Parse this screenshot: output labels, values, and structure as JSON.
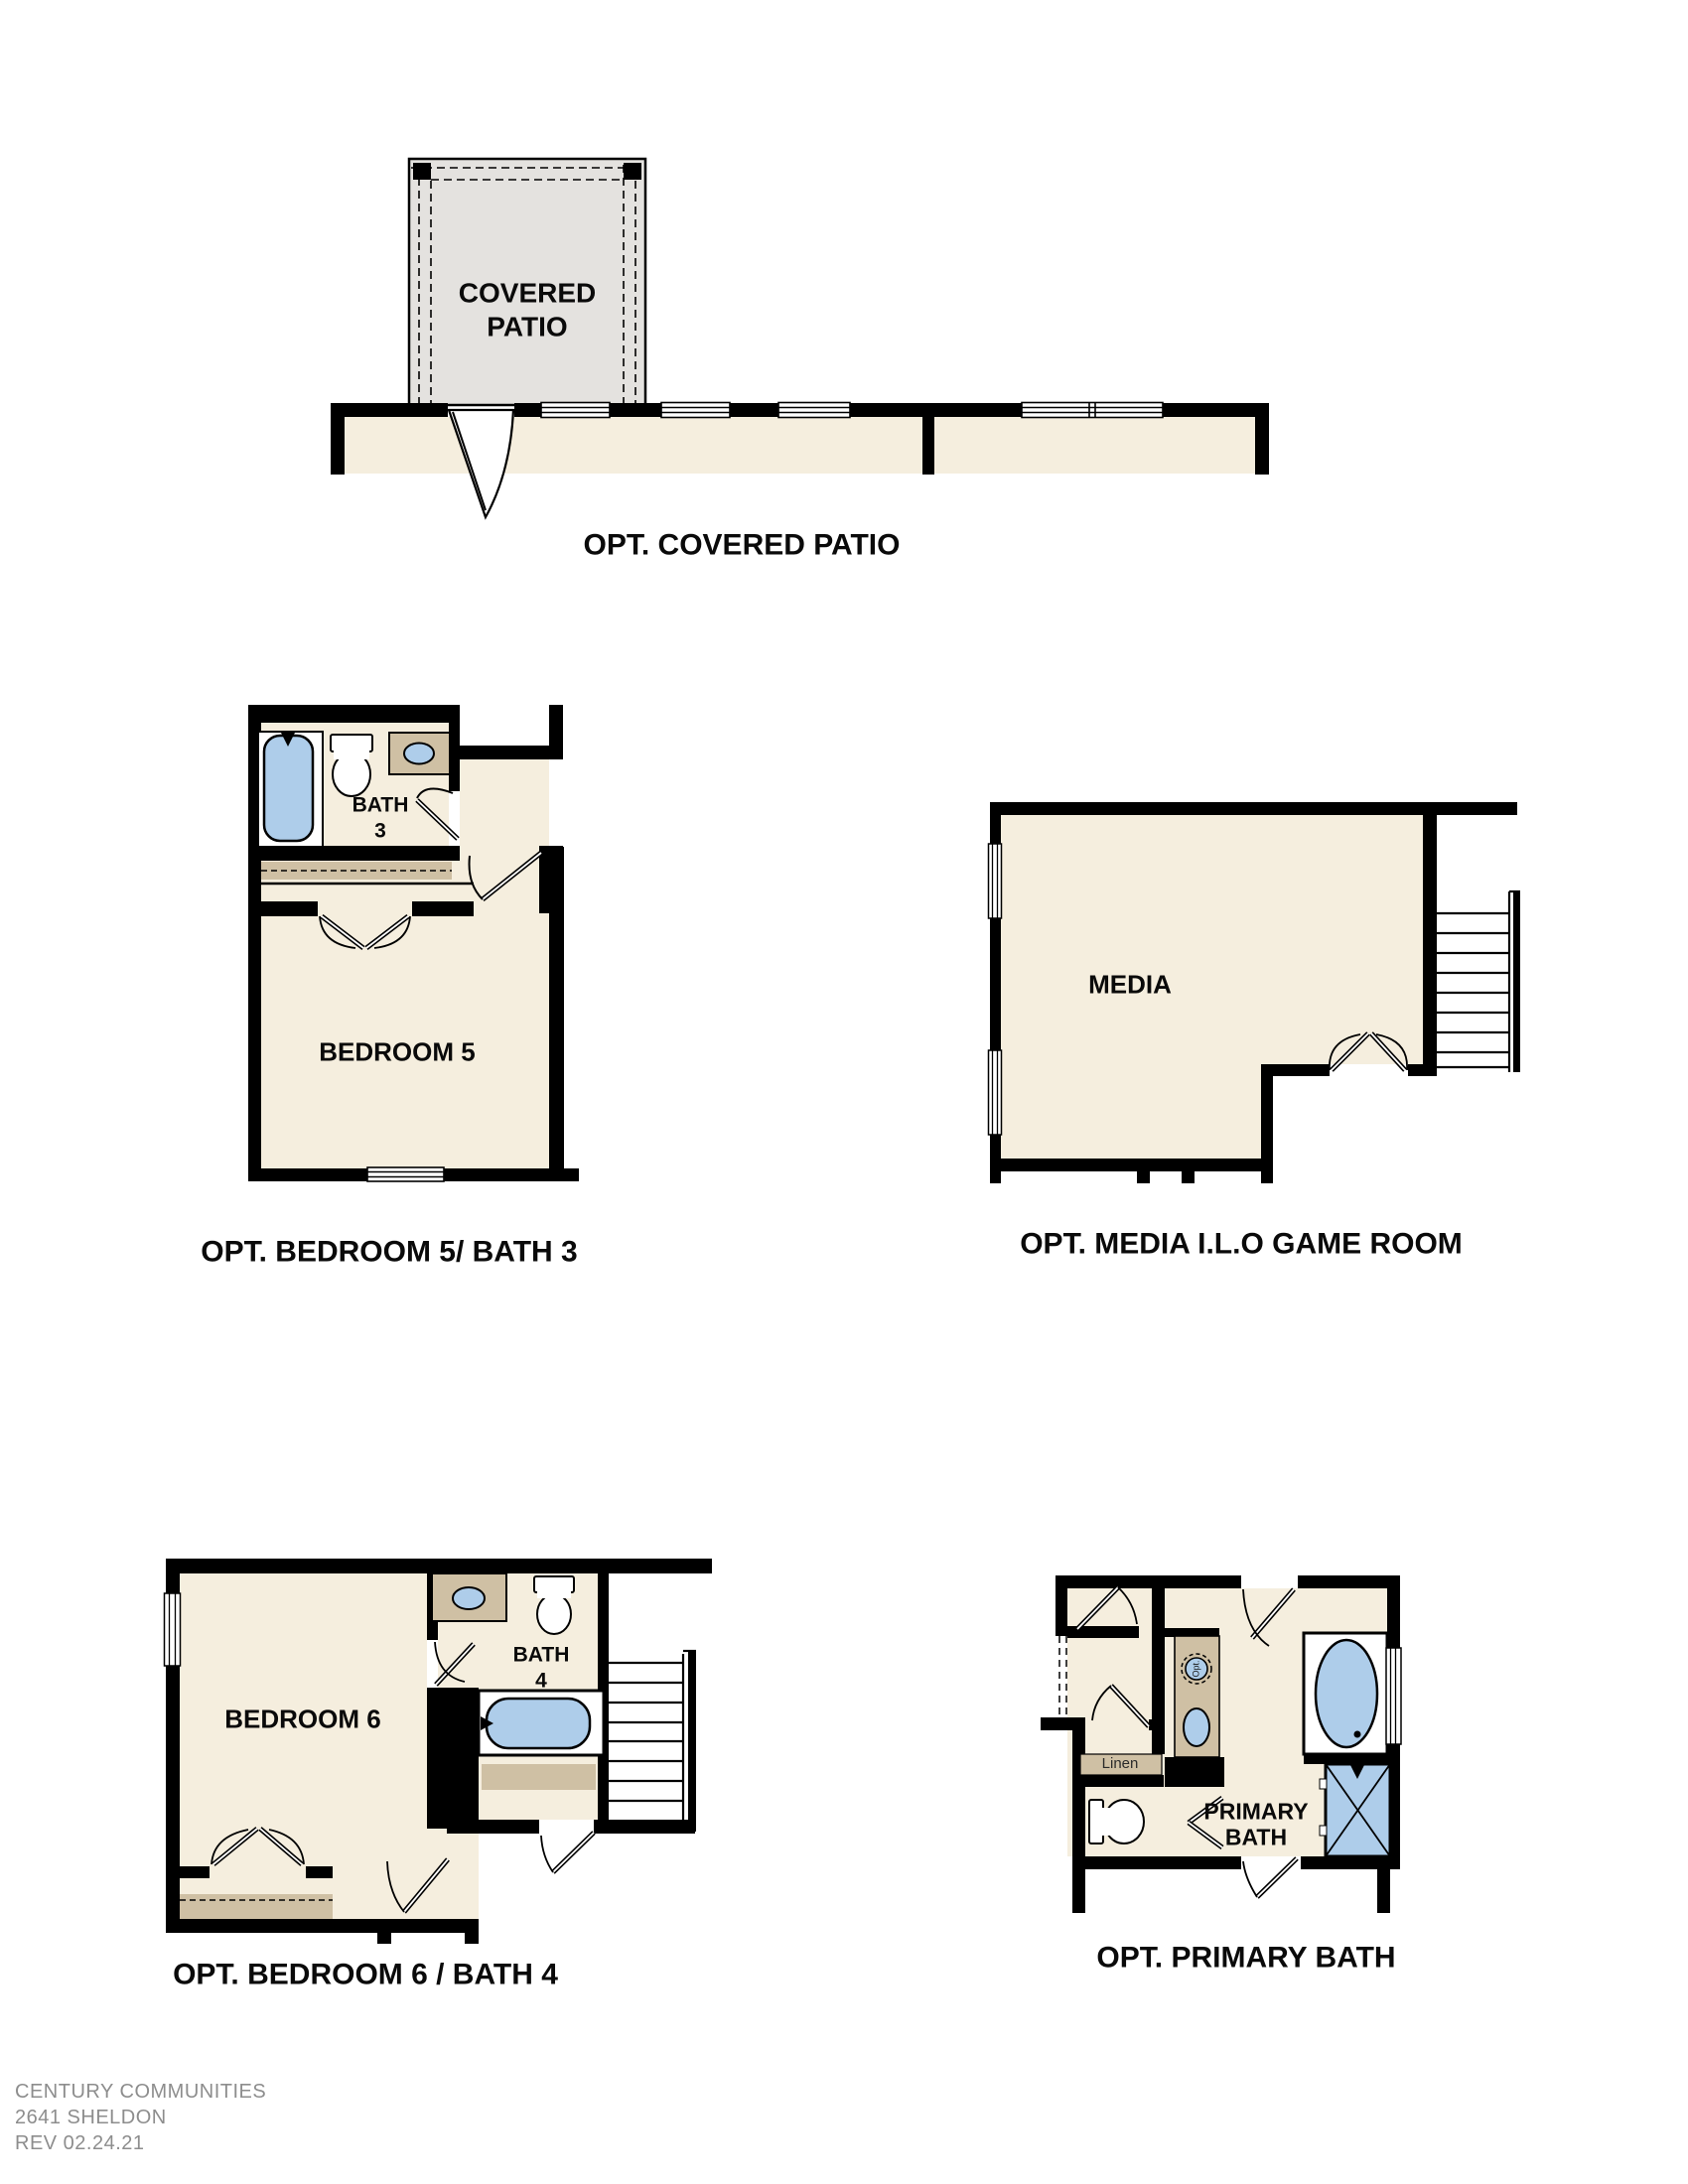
{
  "document": {
    "type": "floor-plan-options-sheet",
    "builder": "CENTURY COMMUNITIES",
    "plan_number": "2641 SHELDON",
    "revision": "REV 02.24.21"
  },
  "plans": {
    "covered_patio": {
      "caption": "OPT. COVERED PATIO",
      "room_label": "COVERED\nPATIO"
    },
    "bedroom5_bath3": {
      "caption": "OPT. BEDROOM 5/ BATH 3",
      "bath_label": "BATH\n3",
      "bedroom_label": "BEDROOM 5"
    },
    "media": {
      "caption": "OPT. MEDIA I.L.O GAME ROOM",
      "room_label": "MEDIA"
    },
    "bedroom6_bath4": {
      "caption": "OPT. BEDROOM 6 / BATH 4",
      "bedroom_label": "BEDROOM 6",
      "bath_label": "BATH\n4"
    },
    "primary_bath": {
      "caption": "OPT. PRIMARY BATH",
      "room_label": "PRIMARY\nBATH",
      "linen_label": "Linen",
      "opt_sink_label": "Opt."
    }
  },
  "footer": {
    "line1": "CENTURY COMMUNITIES",
    "line2": "2641 SHELDON",
    "line3": "REV 02.24.21"
  },
  "colors": {
    "walls": "#000000",
    "floor": "#f5eede",
    "patio_floor": "#e4e2df",
    "cabinetry": "#cfc0a4",
    "fixtures": "#aecdea",
    "caption_text": "#0a0a0a",
    "footer_text": "#8d8d8d"
  }
}
